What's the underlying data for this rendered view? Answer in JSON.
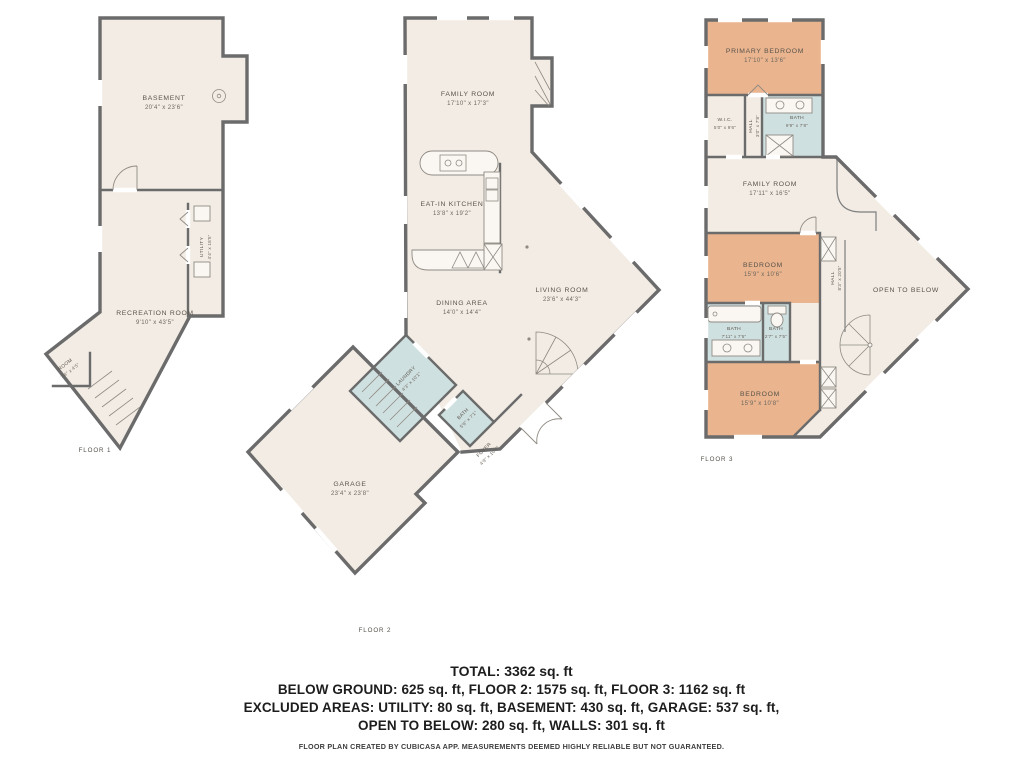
{
  "colors": {
    "wall": "#6b6b6b",
    "floor_fill": "#f2ece4",
    "bedroom_fill": "#e9b48e",
    "wet_room_fill": "#cfe0e0",
    "background": "#ffffff"
  },
  "floors": [
    {
      "label": "FLOOR 1",
      "rooms": [
        {
          "name": "BASEMENT",
          "dims": "20'4\" x 23'6\""
        },
        {
          "name": "UTILITY",
          "dims": "4'4\" x 18'5\""
        },
        {
          "name": "RECREATION ROOM",
          "dims": "9'10\" x 43'5\""
        },
        {
          "name": "ROOM",
          "dims": "7'4\" x 4'5\""
        }
      ]
    },
    {
      "label": "FLOOR 2",
      "rooms": [
        {
          "name": "FAMILY ROOM",
          "dims": "17'10\" x 17'3\""
        },
        {
          "name": "EAT-IN KITCHEN",
          "dims": "13'8\" x 19'2\""
        },
        {
          "name": "DINING AREA",
          "dims": "14'0\" x 14'4\""
        },
        {
          "name": "LIVING ROOM",
          "dims": "23'6\" x 44'3\""
        },
        {
          "name": "LAUNDRY",
          "dims": "4'3\" x 10'1\""
        },
        {
          "name": "BATH",
          "dims": "5'8\" x 7'1\""
        },
        {
          "name": "FOYER",
          "dims": "4'9\" x 10'4\""
        },
        {
          "name": "GARAGE",
          "dims": "23'4\" x 23'8\""
        }
      ]
    },
    {
      "label": "FLOOR 3",
      "rooms": [
        {
          "name": "PRIMARY BEDROOM",
          "dims": "17'10\" x 13'6\""
        },
        {
          "name": "W.I.C.",
          "dims": "5'0\" x 9'6\""
        },
        {
          "name": "HALL",
          "dims": "3'0\" x 7'8\""
        },
        {
          "name": "BATH",
          "dims": "9'9\" x 7'8\""
        },
        {
          "name": "FAMILY ROOM",
          "dims": "17'11\" x 16'5\""
        },
        {
          "name": "BEDROOM",
          "dims": "15'9\" x 10'6\""
        },
        {
          "name": "HALL",
          "dims": "8'3\" x 20'5\""
        },
        {
          "name": "BATH",
          "dims": "7'11\" x 7'5\""
        },
        {
          "name": "BATH",
          "dims": "2'7\" x 7'5\""
        },
        {
          "name": "BEDROOM",
          "dims": "15'9\" x 10'8\""
        },
        {
          "name": "OPEN TO BELOW",
          "dims": ""
        }
      ]
    }
  ],
  "footer": {
    "total": "TOTAL: 3362 sq. ft",
    "line2": "BELOW GROUND: 625 sq. ft, FLOOR 2: 1575 sq. ft, FLOOR 3: 1162 sq. ft",
    "line3": "EXCLUDED AREAS: UTILITY: 80 sq. ft, BASEMENT: 430 sq. ft, GARAGE: 537 sq. ft,",
    "line4": "OPEN TO BELOW: 280 sq. ft, WALLS: 301 sq. ft",
    "disclaimer": "FLOOR PLAN CREATED BY CUBICASA APP. MEASUREMENTS DEEMED HIGHLY RELIABLE BUT NOT GUARANTEED."
  }
}
